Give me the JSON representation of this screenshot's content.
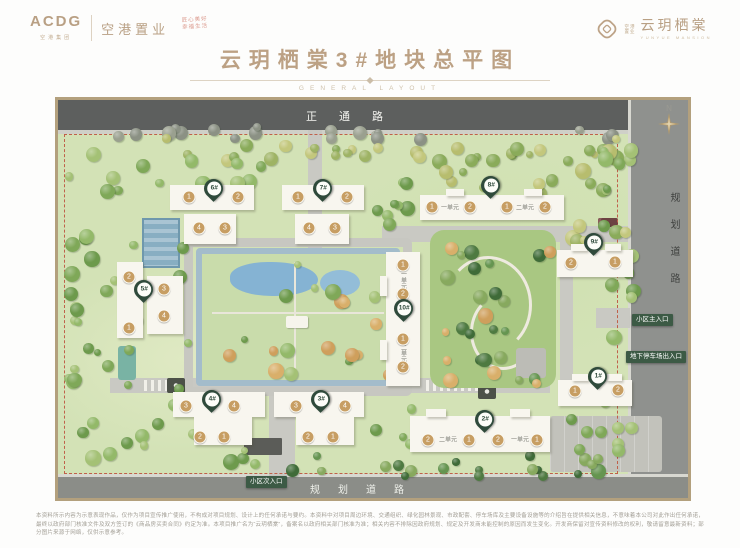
{
  "header": {
    "logo_main": "ACDG",
    "logo_main_sub": "空港集团",
    "company": "空港置业",
    "stamp1": "匠心美好",
    "stamp2": "幸福生活",
    "brand_small1": "空港",
    "brand_small2": "置业",
    "brand": "云玥栖棠",
    "brand_en": "YUNYUE MANSION"
  },
  "title": {
    "text": "云玥栖棠3#地块总平图",
    "subtitle": "GENERAL LAYOUT"
  },
  "map": {
    "road_top": "正通路",
    "road_right": "规划道路",
    "road_bottom": "规划道路",
    "compass": "N",
    "entrances": [
      {
        "id": "main-entrance",
        "label": "小区主入口",
        "x": 574,
        "y": 214
      },
      {
        "id": "garage-entrance",
        "label": "地下停车场出入口",
        "x": 568,
        "y": 251
      },
      {
        "id": "secondary-entrance",
        "label": "小区次入口",
        "x": 188,
        "y": 376
      }
    ],
    "buildings": [
      {
        "id": "6#",
        "pin": [
          155,
          95
        ],
        "slabs": [
          [
            112,
            85,
            84,
            25
          ],
          [
            126,
            114,
            52,
            30
          ]
        ],
        "circles": [
          [
            131,
            97,
            "1"
          ],
          [
            180,
            97,
            "2"
          ],
          [
            141,
            128,
            "4"
          ],
          [
            167,
            128,
            "3"
          ]
        ],
        "labels": [],
        "vlabels": []
      },
      {
        "id": "7#",
        "pin": [
          264,
          95
        ],
        "slabs": [
          [
            224,
            85,
            82,
            25
          ],
          [
            237,
            114,
            54,
            30
          ]
        ],
        "circles": [
          [
            240,
            97,
            "1"
          ],
          [
            289,
            97,
            "2"
          ],
          [
            251,
            128,
            "4"
          ],
          [
            277,
            128,
            "3"
          ]
        ],
        "labels": [],
        "vlabels": []
      },
      {
        "id": "5#",
        "pin": [
          85,
          196
        ],
        "slabs": [
          [
            59,
            162,
            26,
            76
          ],
          [
            89,
            176,
            36,
            58
          ]
        ],
        "circles": [
          [
            71,
            177,
            "2"
          ],
          [
            71,
            228,
            "1"
          ],
          [
            106,
            189,
            "3"
          ],
          [
            106,
            216,
            "4"
          ]
        ],
        "labels": [],
        "vlabels": []
      },
      {
        "id": "8#",
        "pin": [
          432,
          92
        ],
        "slabs": [
          [
            362,
            95,
            144,
            25
          ],
          [
            388,
            89,
            18,
            7
          ],
          [
            466,
            89,
            18,
            7
          ]
        ],
        "circles": [
          [
            374,
            107,
            "1"
          ],
          [
            412,
            107,
            "2"
          ],
          [
            449,
            107,
            "1"
          ],
          [
            487,
            107,
            "2"
          ]
        ],
        "labels": [
          [
            392,
            107,
            "一单元"
          ],
          [
            467,
            107,
            "二单元"
          ]
        ],
        "vlabels": []
      },
      {
        "id": "9#",
        "pin": [
          535,
          149
        ],
        "slabs": [
          [
            499,
            150,
            76,
            27
          ],
          [
            513,
            144,
            16,
            7
          ],
          [
            547,
            144,
            16,
            7
          ]
        ],
        "circles": [
          [
            513,
            163,
            "2"
          ],
          [
            557,
            162,
            "1"
          ]
        ],
        "labels": [],
        "vlabels": []
      },
      {
        "id": "10#",
        "pin": [
          345,
          215
        ],
        "slabs": [
          [
            328,
            152,
            34,
            134
          ],
          [
            322,
            176,
            7,
            20
          ],
          [
            322,
            240,
            7,
            20
          ]
        ],
        "circles": [
          [
            345,
            165,
            "1"
          ],
          [
            345,
            194,
            "2"
          ],
          [
            345,
            239,
            "1"
          ],
          [
            345,
            267,
            "2"
          ]
        ],
        "labels": [],
        "vlabels": [
          [
            345,
            180,
            "一单元"
          ],
          [
            345,
            253,
            "二单元"
          ]
        ]
      },
      {
        "id": "4#",
        "pin": [
          153,
          306
        ],
        "slabs": [
          [
            115,
            292,
            92,
            25
          ],
          [
            136,
            317,
            58,
            28
          ]
        ],
        "circles": [
          [
            128,
            306,
            "3"
          ],
          [
            176,
            306,
            "4"
          ],
          [
            142,
            337,
            "2"
          ],
          [
            166,
            337,
            "1"
          ]
        ],
        "labels": [],
        "vlabels": []
      },
      {
        "id": "3#",
        "pin": [
          262,
          306
        ],
        "slabs": [
          [
            216,
            292,
            90,
            25
          ],
          [
            238,
            317,
            58,
            28
          ]
        ],
        "circles": [
          [
            238,
            306,
            "3"
          ],
          [
            287,
            306,
            "4"
          ],
          [
            250,
            337,
            "2"
          ],
          [
            275,
            337,
            "1"
          ]
        ],
        "labels": [],
        "vlabels": []
      },
      {
        "id": "1#",
        "pin": [
          539,
          283
        ],
        "slabs": [
          [
            500,
            280,
            74,
            26
          ],
          [
            514,
            274,
            16,
            7
          ],
          [
            548,
            274,
            16,
            7
          ]
        ],
        "circles": [
          [
            517,
            291,
            "1"
          ],
          [
            560,
            290,
            "2"
          ]
        ],
        "labels": [],
        "vlabels": []
      },
      {
        "id": "2#",
        "pin": [
          426,
          326
        ],
        "slabs": [
          [
            352,
            316,
            140,
            36
          ],
          [
            368,
            309,
            20,
            8
          ],
          [
            452,
            309,
            20,
            8
          ]
        ],
        "circles": [
          [
            370,
            340,
            "2"
          ],
          [
            411,
            340,
            "1"
          ],
          [
            440,
            340,
            "2"
          ],
          [
            479,
            340,
            "1"
          ]
        ],
        "labels": [
          [
            390,
            339,
            "二单元"
          ],
          [
            462,
            339,
            "一单元"
          ]
        ],
        "vlabels": []
      }
    ]
  },
  "footer": {
    "disclaimer": "本资料所示内容为示意表现作品，仅作为项目宣传推广使用，不构成对项目规划、设计上的任何承诺与要约。本资料中对项目周边环境、交通组织、绿化园林景观、市政配套、停车场库及主要设备设施等的介绍旨在提供相关信息，不意味着本公司对此作出任何承诺，最终以政府部门核准文件及双方签订的《商品房买卖合同》约定为准。本项目推广名为“云玥栖棠”，备案名以政府相关部门核准为准；相关内容不排除因政府规划、规定及开发商未能控制的原因而发生变化。开发商保留对宣传资料修改的权利，敬请留意最新资料；部分图片来源于网络，仅供示意参考。"
  },
  "colors": {
    "accent_gold": "#bca184",
    "pin_green": "#2f4a3b",
    "badge_green": "#3c5a45",
    "circle_gold": "#c79e63",
    "road_dark": "#5d5f5e",
    "boundary_red": "#c0604a",
    "site_green": "#d3e2b6"
  }
}
